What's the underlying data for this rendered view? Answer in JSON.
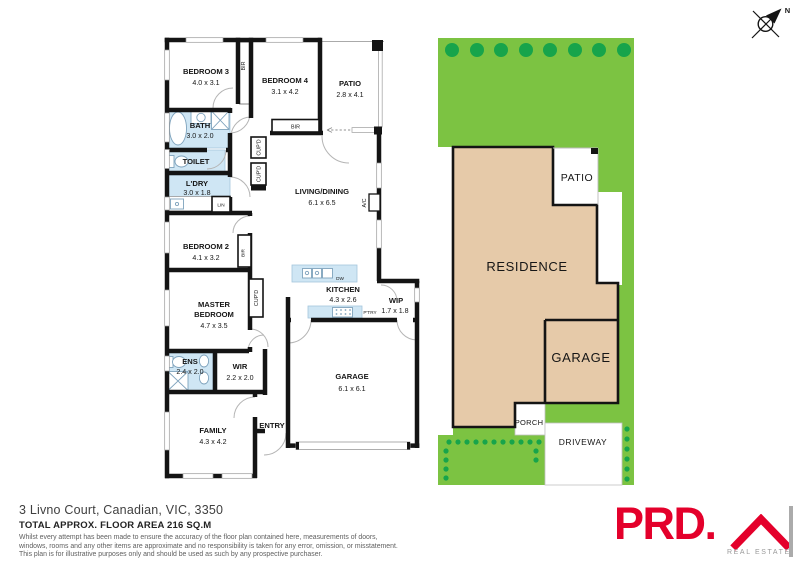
{
  "compass": {
    "north": "N"
  },
  "floorplan": {
    "bedroom3": {
      "name": "BEDROOM 3",
      "dims": "4.0 x 3.1"
    },
    "bedroom4": {
      "name": "BEDROOM 4",
      "dims": "3.1 x 4.2"
    },
    "patio": {
      "name": "PATIO",
      "dims": "2.8 x 4.1"
    },
    "bath": {
      "name": "BATH",
      "dims": "3.0 x 2.0"
    },
    "toilet": {
      "name": "TOILET"
    },
    "ldry": {
      "name": "L'DRY",
      "dims": "3.0 x 1.8"
    },
    "lin": {
      "name": "LIN"
    },
    "bir_bed3": {
      "name": "BIR"
    },
    "bir_bed4": {
      "name": "BIR"
    },
    "bir_bed2": {
      "name": "BIR"
    },
    "cupd_hall1": {
      "name": "CUP'D"
    },
    "cupd_hall2": {
      "name": "CUP'D"
    },
    "cupd_kitchen": {
      "name": "CUP'D"
    },
    "living": {
      "name": "LIVING/DINING",
      "dims": "6.1 x 6.5"
    },
    "ac": {
      "name": "A/C"
    },
    "bedroom2": {
      "name": "BEDROOM 2",
      "dims": "4.1 x 3.2"
    },
    "master": {
      "name1": "MASTER",
      "name2": "BEDROOM",
      "dims": "4.7 x 3.5"
    },
    "kitchen": {
      "name": "KITCHEN",
      "dims": "4.3 x 2.6"
    },
    "dw": {
      "name": "DW"
    },
    "ptry": {
      "name": "P'TRY"
    },
    "wip": {
      "name": "WIP",
      "dims": "1.7 x 1.8"
    },
    "ens": {
      "name": "ENS",
      "dims": "2.4 x 2.0"
    },
    "wir": {
      "name": "WIR",
      "dims": "2.2 x 2.0"
    },
    "family": {
      "name": "FAMILY",
      "dims": "4.3 x 4.2"
    },
    "entry": {
      "name": "ENTRY"
    },
    "garage": {
      "name": "GARAGE",
      "dims": "6.1 x 6.1"
    }
  },
  "siteplan": {
    "residence": "RESIDENCE",
    "patio": "PATIO",
    "garage": "GARAGE",
    "porch": "PORCH",
    "driveway": "DRIVEWAY"
  },
  "footer": {
    "address": "3 Livno Court, Canadian, VIC, 3350",
    "area": "TOTAL APPROX. FLOOR AREA 216 SQ.M",
    "disclaimer1": "Whilst every attempt has been made to ensure the accuracy of the floor plan contained here, measurements of doors,",
    "disclaimer2": "windows, rooms and any other items are approximate and no responsibility is taken for any error, omission, or misstatement.",
    "disclaimer3": "This plan is for illustrative purposes only and should be used as such by any prospective purchaser."
  },
  "logo": {
    "brand": "PRD.",
    "tagline": "REAL ESTATE"
  },
  "colors": {
    "wall": "#141414",
    "wet_area": "#cfe6f4",
    "grass": "#7cc342",
    "tree": "#17a44b",
    "building": "#e6caa9",
    "brand_red": "#e4002b"
  }
}
